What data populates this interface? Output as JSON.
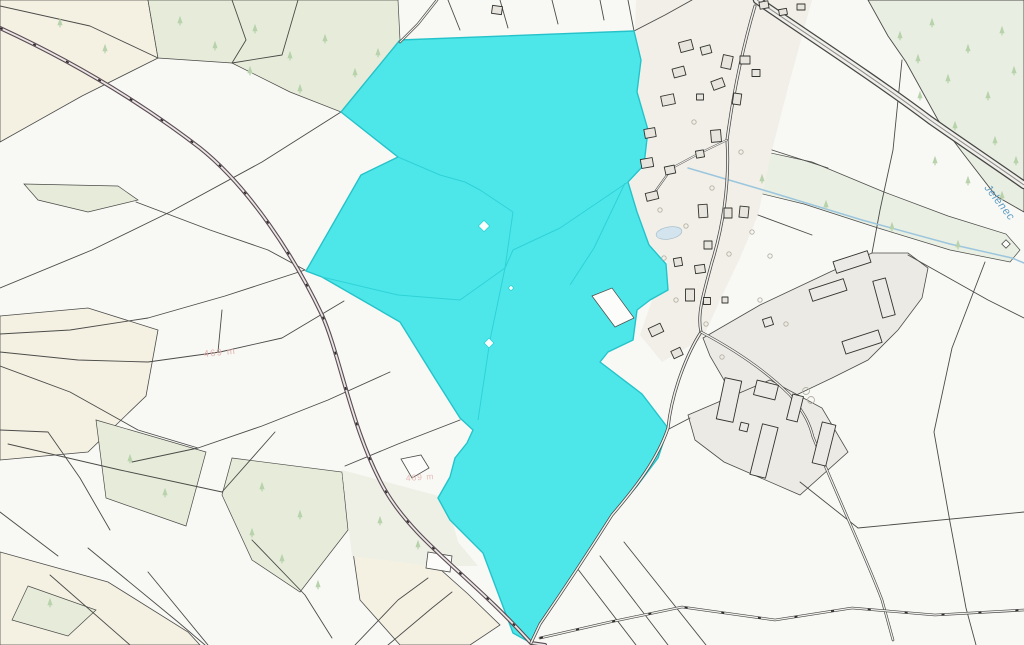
{
  "labels": {
    "stream": "Jelenec",
    "elevation_a": "469 m",
    "elevation_b": "469 m"
  },
  "symbols": {
    "tree": "conifer-tree-icon",
    "garden_tree": "small-circle-tree-icon",
    "selection": "cyan-highlighted-parcels"
  },
  "colors": {
    "bg": "#f8f8f5",
    "white_parcel": "#fcfcfa",
    "parcel_line": "#4b4b49",
    "selection_fill": "#4de7ea",
    "selection_stroke": "#25c3c9",
    "selection_inner": "#2ed2d6",
    "village_fill": "#f1efe7",
    "building_fill": "#e7e5de",
    "building_stroke": "#33332f",
    "farm_fill": "#eceae4",
    "farm_building_fill": "#eceae6",
    "forest_fill": "#e8eee1",
    "strip_fill": "#e9efe2",
    "green_patch": "#e6ecd9",
    "pale_zone": "#eef0e5",
    "cream": "#f4f1e3",
    "tree": "#b8d2ac",
    "road_casing": "#454543",
    "road_fill": "#f0efec",
    "road_tick": "#2e2a2c",
    "main_road_casing": "#5a4c52",
    "main_road_fill": "#eae6e6",
    "water": "#9cc6de",
    "pond": "#d3e4ef",
    "pond_stroke": "#9db8c8",
    "water_label": "#5d9cc3",
    "elevation_label": "#dfa9a2",
    "garden_symbol": "#b5b2a5"
  }
}
